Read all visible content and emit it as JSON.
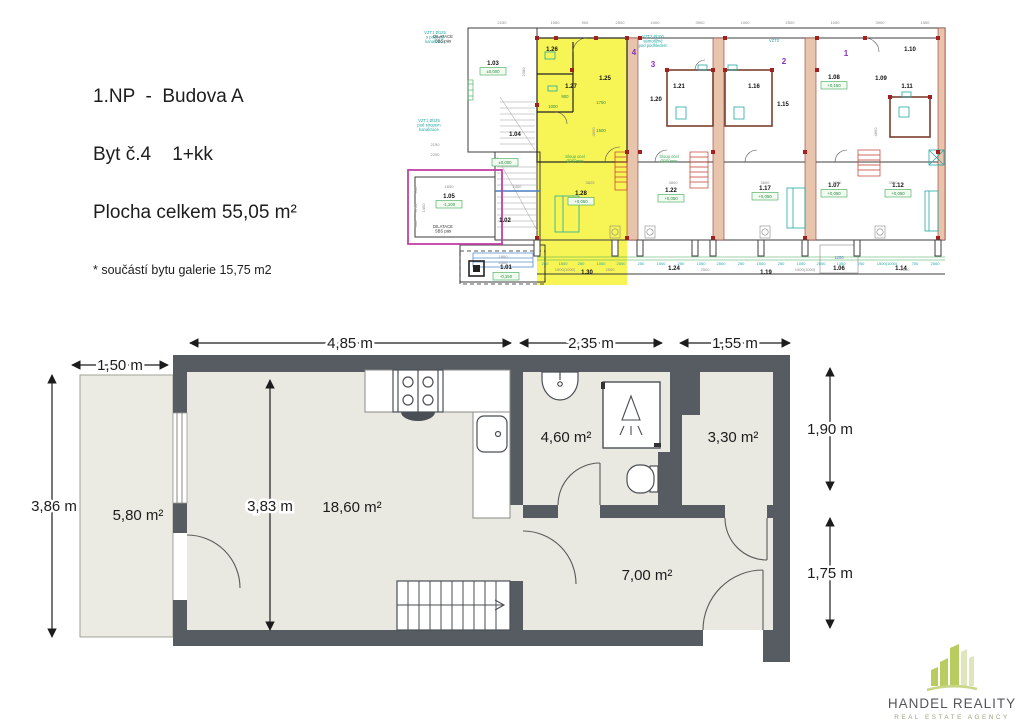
{
  "header": {
    "line1": "1.NP  -  Budova A",
    "line2": "Byt č.4    1+kk",
    "line3": "Plocha celkem 55,05 m²",
    "line4": "* součástí bytu galerie 15,75 m2"
  },
  "main_plan": {
    "dim_4_85": "4,85 m",
    "dim_2_35": "2,35 m",
    "dim_1_55": "1,55 m",
    "dim_1_50": "1,50 m",
    "dim_3_86": "3,86 m",
    "dim_3_83": "3,83 m",
    "dim_1_90": "1,90 m",
    "dim_1_75": "1,75 m",
    "area_terrace": "5,80 m²",
    "area_living": "18,60 m²",
    "area_bathroom": "4,60 m²",
    "area_room": "3,30 m²",
    "area_hall": "7,00 m²"
  },
  "site_plan": {
    "rooms": [
      {
        "label": "1.03",
        "x": 88,
        "y": 53
      },
      {
        "label": "1.04",
        "x": 110,
        "y": 124
      },
      {
        "label": "1.05",
        "x": 44,
        "y": 186
      },
      {
        "label": "1.02",
        "x": 100,
        "y": 210
      },
      {
        "label": "1.01",
        "x": 101,
        "y": 257
      },
      {
        "label": "1.26",
        "x": 147,
        "y": 39
      },
      {
        "label": "1.27",
        "x": 166,
        "y": 76
      },
      {
        "label": "1.25",
        "x": 200,
        "y": 68
      },
      {
        "label": "1.28",
        "x": 176,
        "y": 183
      },
      {
        "label": "1.30",
        "x": 182,
        "y": 262
      },
      {
        "label": "1.20",
        "x": 251,
        "y": 89
      },
      {
        "label": "1.21",
        "x": 274,
        "y": 76
      },
      {
        "label": "1.22",
        "x": 266,
        "y": 180
      },
      {
        "label": "1.24",
        "x": 269,
        "y": 258
      },
      {
        "label": "1.16",
        "x": 349,
        "y": 76
      },
      {
        "label": "1.15",
        "x": 378,
        "y": 94
      },
      {
        "label": "1.17",
        "x": 360,
        "y": 178
      },
      {
        "label": "1.19",
        "x": 361,
        "y": 262
      },
      {
        "label": "1.08",
        "x": 429,
        "y": 67
      },
      {
        "label": "1.07",
        "x": 429,
        "y": 175
      },
      {
        "label": "1.06",
        "x": 434,
        "y": 258
      },
      {
        "label": "1.09",
        "x": 476,
        "y": 68
      },
      {
        "label": "1.10",
        "x": 505,
        "y": 39
      },
      {
        "label": "1.11",
        "x": 502,
        "y": 76
      },
      {
        "label": "1.12",
        "x": 493,
        "y": 175
      },
      {
        "label": "1.14",
        "x": 496,
        "y": 258
      }
    ],
    "unit_numbers": [
      {
        "n": "4",
        "x": 229,
        "y": 43
      },
      {
        "n": "3",
        "x": 248,
        "y": 55
      },
      {
        "n": "2",
        "x": 379,
        "y": 52
      },
      {
        "n": "1",
        "x": 441,
        "y": 44
      }
    ],
    "elevations": [
      {
        "v": "±0,000",
        "x": 88,
        "y": 61
      },
      {
        "v": "-1,100",
        "x": 44,
        "y": 194
      },
      {
        "v": "±0,000",
        "x": 100,
        "y": 152
      },
      {
        "v": "-0,150",
        "x": 101,
        "y": 266
      },
      {
        "v": "+0,050",
        "x": 176,
        "y": 191
      },
      {
        "v": "+0,050",
        "x": 266,
        "y": 188
      },
      {
        "v": "+0,050",
        "x": 360,
        "y": 186
      },
      {
        "v": "+0,150",
        "x": 429,
        "y": 75
      },
      {
        "v": "+0,050",
        "x": 429,
        "y": 183
      },
      {
        "v": "+0,050",
        "x": 493,
        "y": 183
      }
    ],
    "annotations": [
      {
        "t": "VZT1 Ø125\ns podesty\nkanalizace",
        "x": 30,
        "y": 22,
        "c": "teal"
      },
      {
        "t": "VZT1 Ø125\npod stropem\nkanalizace",
        "x": 24,
        "y": 110,
        "c": "teal"
      },
      {
        "t": "VZT2 Ø100\nsamotížné\npod podhledem",
        "x": 248,
        "y": 26,
        "c": "teal"
      },
      {
        "t": "VZT2",
        "x": 369,
        "y": 30,
        "c": "teal"
      },
      {
        "t": "Sloup ocel\nØ250mm",
        "x": 170,
        "y": 146,
        "c": "green"
      },
      {
        "t": "Sloup ocel\nØ250mm",
        "x": 264,
        "y": 146,
        "c": "green"
      },
      {
        "t": "DILATACE\nSBS pás",
        "x": 38,
        "y": 26,
        "c": "black"
      },
      {
        "t": "DILATACE\nSBS pás",
        "x": 38,
        "y": 216,
        "c": "black"
      },
      {
        "t": "1200",
        "x": 434,
        "y": 247,
        "c": "blue"
      }
    ],
    "top_dims": [
      {
        "t": "2150",
        "x": 97
      },
      {
        "t": "1550",
        "x": 150
      },
      {
        "t": "900",
        "x": 180
      },
      {
        "t": "2500",
        "x": 215
      },
      {
        "t": "1000",
        "x": 250
      },
      {
        "t": "3900",
        "x": 295
      },
      {
        "t": "1000",
        "x": 340
      },
      {
        "t": "2500",
        "x": 385
      },
      {
        "t": "1000",
        "x": 430
      },
      {
        "t": "3900",
        "x": 475
      },
      {
        "t": "1550",
        "x": 520
      }
    ],
    "bottom_dims": [
      {
        "t": "250",
        "x": 140
      },
      {
        "t": "1500",
        "x": 158
      },
      {
        "t": "250",
        "x": 176
      },
      {
        "t": "1050",
        "x": 196
      },
      {
        "t": "2500",
        "x": 216
      },
      {
        "t": "250",
        "x": 236
      },
      {
        "t": "1500",
        "x": 256
      },
      {
        "t": "250",
        "x": 276
      },
      {
        "t": "1050",
        "x": 296
      },
      {
        "t": "2500",
        "x": 316
      },
      {
        "t": "250",
        "x": 336
      },
      {
        "t": "1500",
        "x": 356
      },
      {
        "t": "250",
        "x": 376
      },
      {
        "t": "1050",
        "x": 396
      },
      {
        "t": "2500",
        "x": 416
      },
      {
        "t": "1350",
        "x": 436
      },
      {
        "t": "250",
        "x": 456
      },
      {
        "t": "1500(1000)",
        "x": 482
      },
      {
        "t": "750",
        "x": 510
      },
      {
        "t": "2500",
        "x": 530
      }
    ],
    "row2_dims": [
      {
        "t": "1500(1000)",
        "x": 160
      },
      {
        "t": "2500",
        "x": 205
      },
      {
        "t": "2500",
        "x": 300
      },
      {
        "t": "1500(1000)",
        "x": 400
      },
      {
        "t": "2500",
        "x": 500
      }
    ],
    "interior_dims": [
      {
        "t": "3825",
        "x": 185,
        "y": 172
      },
      {
        "t": "3800",
        "x": 268,
        "y": 172
      },
      {
        "t": "3600",
        "x": 360,
        "y": 172
      },
      {
        "t": "3900",
        "x": 488,
        "y": 172
      },
      {
        "t": "2400",
        "x": 112,
        "y": 176
      },
      {
        "t": "1800",
        "x": 98,
        "y": 246
      },
      {
        "t": "2400",
        "x": 98,
        "y": 252
      },
      {
        "t": "1650",
        "x": 44,
        "y": 176
      },
      {
        "t": "2150",
        "x": 30,
        "y": 134
      },
      {
        "t": "1500",
        "x": 432,
        "y": 172
      },
      {
        "t": "2250",
        "x": 30,
        "y": 144
      }
    ],
    "green_dims": [
      {
        "t": "1750",
        "x": 196,
        "y": 92
      },
      {
        "t": "1500",
        "x": 196,
        "y": 120
      },
      {
        "t": "900",
        "x": 160,
        "y": 86
      },
      {
        "t": "1000",
        "x": 148,
        "y": 96
      }
    ],
    "left_dims": [
      {
        "t": "3750",
        "x": 12,
        "y": 196
      },
      {
        "t": "900",
        "x": 12,
        "y": 178
      },
      {
        "t": "300",
        "x": 12,
        "y": 212
      },
      {
        "t": "1450",
        "x": 20,
        "y": 196
      },
      {
        "t": "2080",
        "x": 120,
        "y": 60
      },
      {
        "t": "4850",
        "x": 190,
        "y": 120
      },
      {
        "t": "4850",
        "x": 472,
        "y": 120
      }
    ]
  },
  "logo": {
    "name": "HANDEL REALITY",
    "tagline1": "REAL ESTATE AGENCY",
    "tagline2": "& PRODUCTION"
  },
  "colors": {
    "unit_highlight": "#f7f455",
    "wall_dark": "#575c62",
    "room_fill": "#e9e9e2",
    "logo_green": "#b9cc60",
    "magenta_outline": "#c23fa5",
    "annotation_green": "#3aa655",
    "annotation_teal": "#21a8a4",
    "unit_number_purple": "#8a2fc0",
    "red_marker": "#a32020"
  }
}
